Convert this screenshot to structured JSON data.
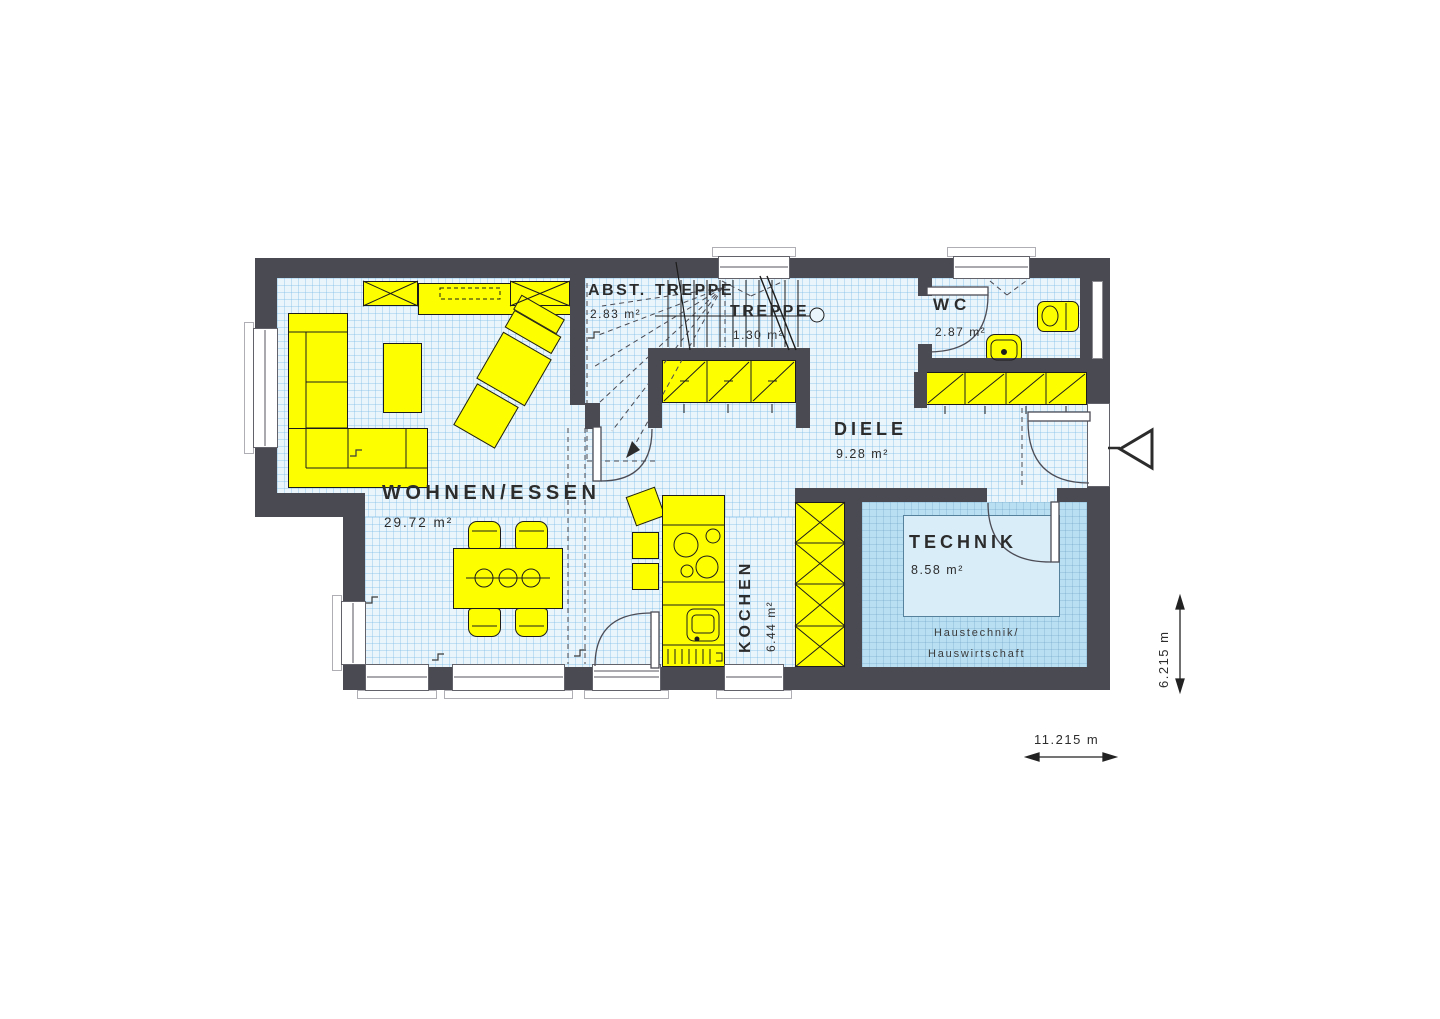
{
  "rooms": {
    "wohnen_essen": {
      "label": "WOHNEN/ESSEN",
      "area": "29.72 m²"
    },
    "abstellraum": {
      "label": "ABST.",
      "area": "2.83 m²"
    },
    "treppe_upper": {
      "label": "TREPPE"
    },
    "treppe": {
      "label": "TREPPE",
      "area": "1.30 m²"
    },
    "wc": {
      "label": "WC",
      "area": "2.87 m²"
    },
    "diele": {
      "label": "DIELE",
      "area": "9.28 m²"
    },
    "kochen": {
      "label": "KOCHEN",
      "area": "6.44 m²"
    },
    "technik": {
      "label": "TECHNIK",
      "area": "8.58 m²",
      "note1": "Haustechnik/",
      "note2": "Hauswirtschaft"
    }
  },
  "dimensions": {
    "width": "11.215 m",
    "depth": "6.215 m"
  },
  "colors": {
    "wall": "#4a4a52",
    "furniture": "#fdff00",
    "floor": "#e9f4fb",
    "technik_floor": "#b9dff2",
    "outline": "#1c1c1c"
  }
}
